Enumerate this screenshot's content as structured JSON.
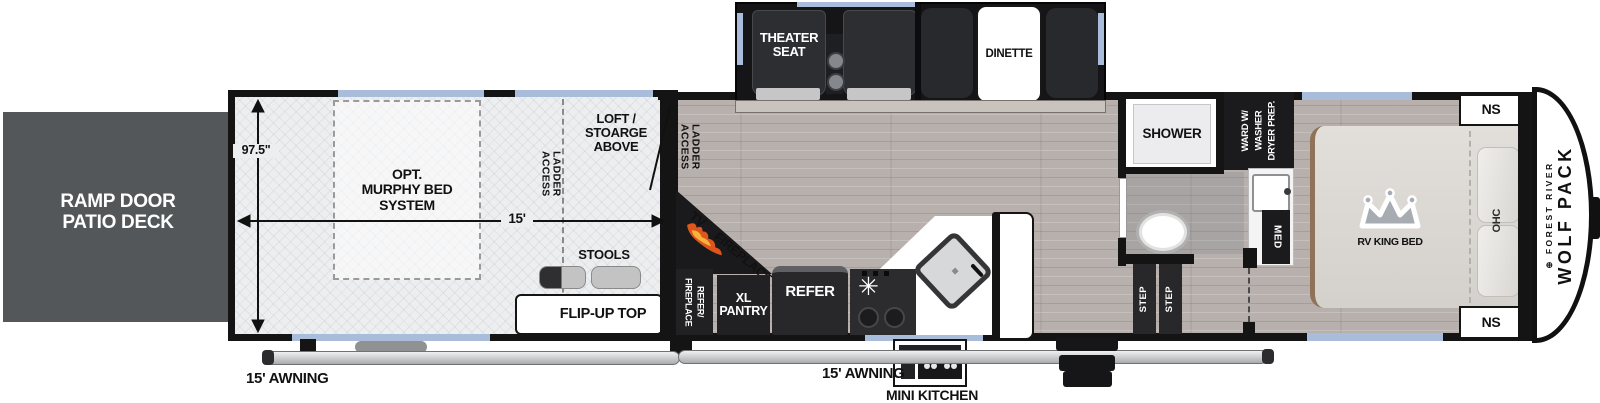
{
  "colors": {
    "wall": "#141414",
    "window": "#a9bcd9",
    "deck": "#54575a",
    "flame": "#e0551c"
  },
  "exterior": {
    "ramp_deck": "RAMP DOOR\nPATIO DECK",
    "awning_left": "15' AWNING",
    "awning_right": "15' AWNING",
    "mini_kitchen": "MINI KITCHEN"
  },
  "garage": {
    "height_dim": "97.5\"",
    "length_dim": "15'",
    "murphy_bed": "OPT.\nMURPHY BED\nSYSTEM",
    "loft": "LOFT / STOARGE\nABOVE",
    "ladder_access": "LADDER ACCESS",
    "stools": "STOOLS",
    "flip_up_top": "FLIP-UP TOP"
  },
  "slideout": {
    "theater_seat": "THEATER\nSEAT",
    "dinette": "DINETTE"
  },
  "living": {
    "ladder_access": "LADDER ACCESS",
    "tv": "TV",
    "fireplace": "FIREPLACE"
  },
  "kitchen": {
    "refer_fireplace": "REFER/\nFIREPLACE",
    "xl_pantry": "XL\nPANTRY",
    "refer": "REFER"
  },
  "bath": {
    "shower": "SHOWER",
    "ward": "WARD W/\nWASHER\nDRYER PREP.",
    "med": "MED",
    "step": "STEP"
  },
  "bedroom": {
    "ns": "NS",
    "bed": "RV KING BED",
    "ohc": "OHC"
  },
  "cap": {
    "maker": "FOREST RIVER",
    "model": "WOLF PACK"
  }
}
